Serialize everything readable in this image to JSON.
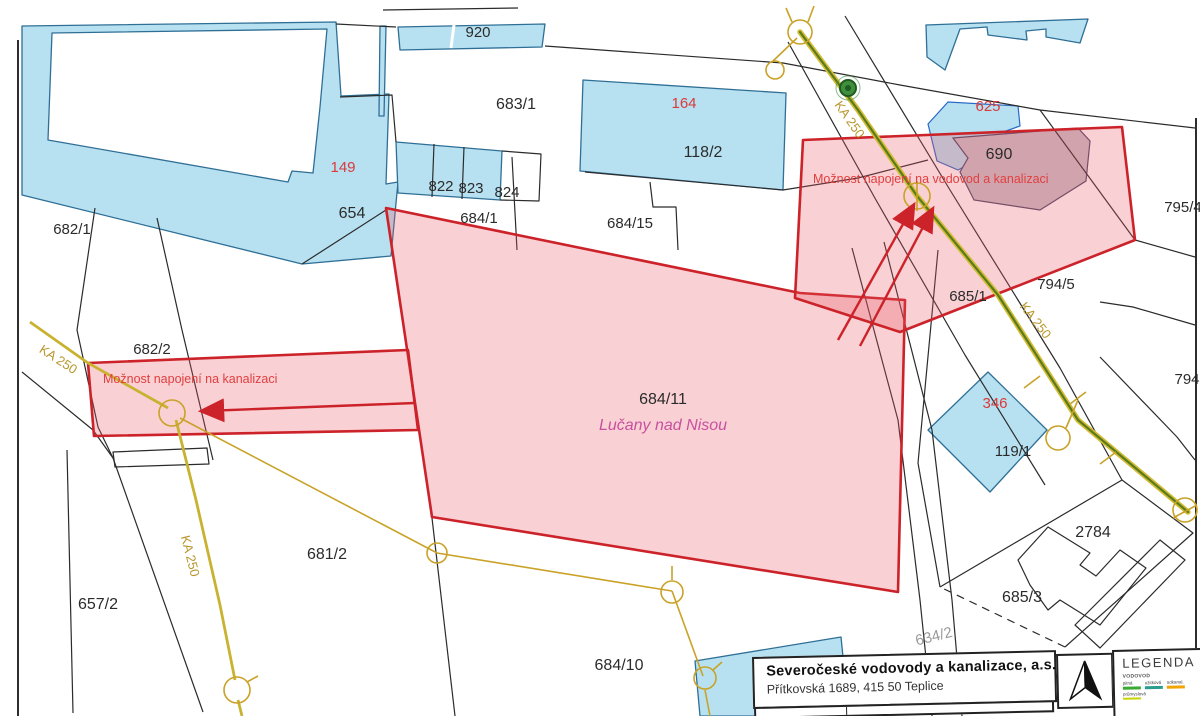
{
  "colors": {
    "highlight_stroke": "#cc2229",
    "highlight_fill": "#e85560",
    "parcel_blue": "#b7e1f1",
    "pipeline_yellow": "#d2bc35",
    "pipeline_green": "#5a7a1e",
    "region_label_pink": "#c850a0",
    "annotation_red": "#e04040"
  },
  "map": {
    "labels": [
      {
        "text": "920",
        "x": 478,
        "y": 37
      },
      {
        "text": "683/1",
        "x": 516,
        "y": 109,
        "size": 16
      },
      {
        "text": "164",
        "x": 684,
        "y": 108,
        "color": "#d93a3a"
      },
      {
        "text": "118/2",
        "x": 703,
        "y": 157,
        "size": 16
      },
      {
        "text": "149",
        "x": 343,
        "y": 172,
        "color": "#d93a3a"
      },
      {
        "text": "654",
        "x": 352,
        "y": 218,
        "size": 16
      },
      {
        "text": "822",
        "x": 441,
        "y": 191
      },
      {
        "text": "823",
        "x": 471,
        "y": 193
      },
      {
        "text": "824",
        "x": 507,
        "y": 197
      },
      {
        "text": "684/1",
        "x": 479,
        "y": 223
      },
      {
        "text": "684/15",
        "x": 630,
        "y": 228
      },
      {
        "text": "682/1",
        "x": 72,
        "y": 234
      },
      {
        "text": "625",
        "x": 988,
        "y": 111,
        "color": "#d93a3a"
      },
      {
        "text": "690",
        "x": 999,
        "y": 159,
        "size": 16
      },
      {
        "text": "795/4",
        "x": 1183,
        "y": 212
      },
      {
        "text": "685/1",
        "x": 968,
        "y": 301
      },
      {
        "text": "794/5",
        "x": 1056,
        "y": 289
      },
      {
        "text": "794",
        "x": 1187,
        "y": 384
      },
      {
        "text": "682/2",
        "x": 152,
        "y": 354
      },
      {
        "text": "684/11",
        "x": 663,
        "y": 404,
        "size": 16
      },
      {
        "text": "Lučany nad Nisou",
        "x": 663,
        "y": 430,
        "size": 16,
        "color": "#c850a0",
        "italic": true,
        "name": "region-label"
      },
      {
        "text": "346",
        "x": 995,
        "y": 408,
        "color": "#d93a3a"
      },
      {
        "text": "119/1",
        "x": 1013,
        "y": 456
      },
      {
        "text": "2784",
        "x": 1093,
        "y": 537,
        "size": 16
      },
      {
        "text": "685/3",
        "x": 1022,
        "y": 602,
        "size": 16
      },
      {
        "text": "681/2",
        "x": 327,
        "y": 559,
        "size": 16
      },
      {
        "text": "657/2",
        "x": 98,
        "y": 609,
        "size": 16
      },
      {
        "text": "684/10",
        "x": 619,
        "y": 670,
        "size": 16
      },
      {
        "text": "634/2",
        "x": 935,
        "y": 641,
        "color": "#9a9a9a",
        "rotate": -14
      },
      {
        "text": "KA 250",
        "x": 846,
        "y": 122,
        "rotate": 55,
        "color": "#b8972e",
        "size": 13,
        "name": "pipeline-label"
      },
      {
        "text": "KA 250",
        "x": 1032,
        "y": 323,
        "rotate": 52,
        "color": "#b8972e",
        "size": 13,
        "name": "pipeline-label"
      },
      {
        "text": "KA 250",
        "x": 56,
        "y": 363,
        "rotate": 33,
        "color": "#b8972e",
        "size": 13,
        "name": "pipeline-label"
      },
      {
        "text": "KA 250",
        "x": 186,
        "y": 557,
        "rotate": 76,
        "color": "#b8972e",
        "size": 13,
        "name": "pipeline-label"
      },
      {
        "text": "Možnost napojení na  kanalizaci",
        "x": 103,
        "y": 383,
        "anchor": "start",
        "color": "#e04040",
        "size": 12.5,
        "name": "annotation-kanalizace"
      },
      {
        "text": "Možnost napojení na vodovod a kanalizaci",
        "x": 813,
        "y": 183,
        "anchor": "start",
        "color": "#e04040",
        "size": 12.5,
        "name": "annotation-vodovod"
      }
    ],
    "infobox": {
      "company": "Severočeské vodovody a kanalizace, a.s.",
      "address": "Přítkovská 1689, 415 50 Teplice"
    },
    "legend": {
      "title": "LEGENDA",
      "section": "VODOVOD",
      "items": [
        {
          "label": "pitná",
          "color": "#3aaa35"
        },
        {
          "label": "užitková",
          "color": "#2a9d8f"
        },
        {
          "label": "odkanal.",
          "color": "#f0a500"
        },
        {
          "label": "průmyslová",
          "color": "#c8d400"
        }
      ]
    }
  }
}
